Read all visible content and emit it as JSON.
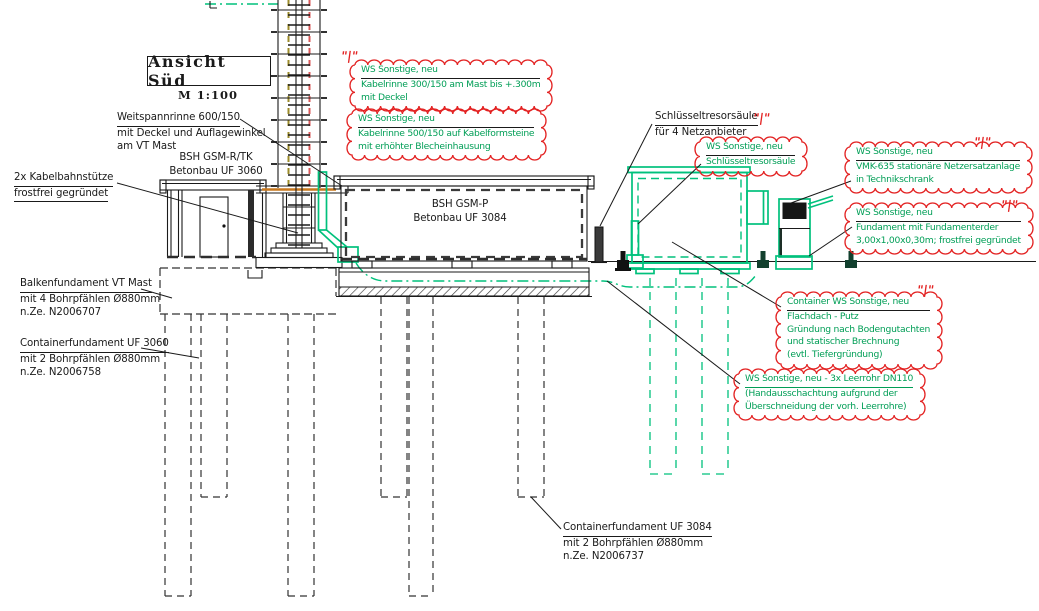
{
  "title": {
    "main": "Ansicht Süd",
    "scale": "M 1:100"
  },
  "labels": {
    "weitspannrinne": {
      "lines": [
        "Weitspannrinne 600/150",
        "mit Deckel und Auflagewinkel",
        "am VT Mast"
      ]
    },
    "bsh_gsm_rtk": {
      "lines": [
        "BSH GSM-R/TK",
        "Betonbau UF 3060"
      ]
    },
    "kabelbahnstuetze": {
      "lines": [
        "2x Kabelbahnstütze",
        "frostfrei gegründet"
      ]
    },
    "balkenfundament": {
      "lines": [
        "Balkenfundament VT Mast",
        "mit 4 Bohrpfählen Ø880mm",
        "n.Ze. N2006707"
      ]
    },
    "containerfundament_3060": {
      "lines": [
        "Containerfundament UF 3060",
        "mit 2 Bohrpfählen Ø880mm",
        "n.Ze. N2006758"
      ]
    },
    "bsh_gsm_p": {
      "lines": [
        "BSH GSM-P",
        "Betonbau UF 3084"
      ]
    },
    "schluesseltresorsaeule": {
      "lines": [
        "Schlüsseltresorsäule",
        "für 4 Netzanbieter"
      ]
    },
    "containerfundament_3084": {
      "lines": [
        "Containerfundament UF 3084",
        "mit 2 Bohrpfählen Ø880mm",
        "n.Ze. N2006737"
      ]
    }
  },
  "annotations": {
    "kabelrinne_300": {
      "lines": [
        "WS Sonstige, neu",
        "Kabelrinne 300/150 am Mast bis +.300m",
        "mit Deckel"
      ]
    },
    "kabelrinne_500": {
      "lines": [
        "WS Sonstige, neu",
        "Kabelrinne 500/150 auf Kabelformsteine",
        "mit erhöhter Blecheinhausung"
      ]
    },
    "schluesseltresorsaeule_neu": {
      "lines": [
        "WS Sonstige, neu",
        "Schlüsseltresorsäule"
      ]
    },
    "netzersatzanlage": {
      "lines": [
        "WS Sonstige, neu",
        "VMK-635 stationäre Netzersatzanlage",
        "in Technikschrank"
      ]
    },
    "fundament": {
      "lines": [
        "WS Sonstige, neu",
        "Fundament mit Fundamenterder",
        "3,00x1,00x0,30m; frostfrei gegründet"
      ]
    },
    "container_neu": {
      "lines": [
        "Container WS Sonstige, neu",
        "Flachdach - Putz",
        "Gründung nach Bodengutachten",
        "und statischer Brechnung",
        "(evtl.  Tiefergründung)"
      ]
    },
    "leerrohr": {
      "lines": [
        "WS Sonstige, neu - 3x Leerrohr DN110",
        "(Handausschachtung aufgrund der",
        "Überschneidung der vorh. Leerrohre)"
      ]
    }
  },
  "revision_marker": "\"|\"",
  "colors": {
    "drawing_green": "#00c17c",
    "annotation_green": "#009e56",
    "cloud_red": "#e32222",
    "mast_red": "#d85858",
    "olive_dashed": "#9b8b2a",
    "orange": "#c8781e",
    "line_black": "#1a1a1a"
  }
}
